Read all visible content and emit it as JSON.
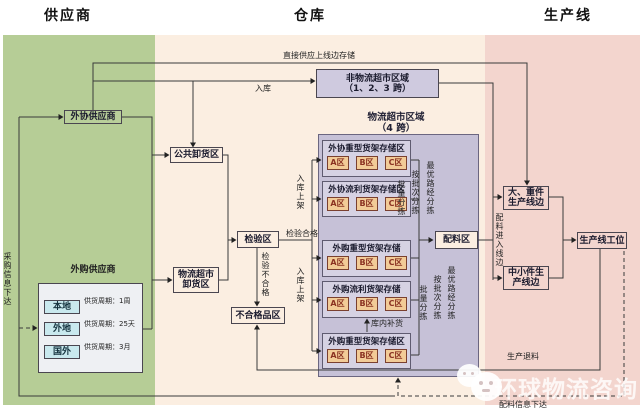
{
  "titles": {
    "supplier": "供应商",
    "warehouse": "仓库",
    "production": "生产线"
  },
  "supplier": {
    "outsourced": "外协供应商",
    "purchased_label": "外购供应商",
    "purchase_info": "采购信息下达",
    "items": [
      {
        "name": "本地",
        "cycle": "供货周期：1周"
      },
      {
        "name": "外地",
        "cycle": "供货周期：25天"
      },
      {
        "name": "国外",
        "cycle": "供货周期：3月"
      }
    ]
  },
  "warehouse": {
    "direct_supply": "直接供应上线边存储",
    "inbound": "入库",
    "non_supermarket_line1": "非物流超市区域",
    "non_supermarket_line2": "（1、2、3 跨）",
    "supermarket_line1": "物流超市区域",
    "supermarket_line2": "（4 跨）",
    "public_unloading": "公共卸货区",
    "supermarket_unloading_line1": "物流超市",
    "supermarket_unloading_line2": "卸货区",
    "inspection": "检验区",
    "inspection_pass": "检验合格",
    "inspection_fail": "检验不合格",
    "defective": "不合格品区",
    "shelving": "入库上架",
    "replenish": "库内补货",
    "batching": "配料区",
    "sort": [
      "批量分拣",
      "按批次分拣",
      "最优路经分拣"
    ],
    "storage": [
      {
        "title": "外协重型货架存储区",
        "zones": [
          "A区",
          "B区",
          "C区"
        ]
      },
      {
        "title": "外协流利货架存储区",
        "zones": [
          "A区",
          "B区",
          "C区"
        ]
      },
      {
        "title": "外购重型货架存储",
        "zones": [
          "A区",
          "B区",
          "C区"
        ]
      },
      {
        "title": "外购流利货架存储",
        "zones": [
          "A区",
          "B区",
          "C区"
        ]
      },
      {
        "title": "外购重型货架存储区",
        "zones": [
          "A区",
          "B区",
          "C区"
        ]
      }
    ]
  },
  "production": {
    "feed": "配料进入线边",
    "heavy_line1": "大、重件",
    "heavy_line2": "生产线边",
    "small_line1": "中小件生",
    "small_line2": "产线边",
    "station": "生产线工位",
    "return_label": "生产退料",
    "material_info": "配料信息下达"
  },
  "watermark": {
    "text": "环球物流咨询"
  },
  "colors": {
    "supplier_zone": "#b6cd96",
    "warehouse_zone": "#fbeee1",
    "production_zone": "#f3d5ce",
    "supermarket_area": "#c6c1d7",
    "non_supermarket_box": "#cfcadf",
    "storage_box": "#d6d2e3",
    "zone_cell": "#f2cb97",
    "supplier_cell": "#c9e9ee",
    "line": "#3a3a3a"
  }
}
